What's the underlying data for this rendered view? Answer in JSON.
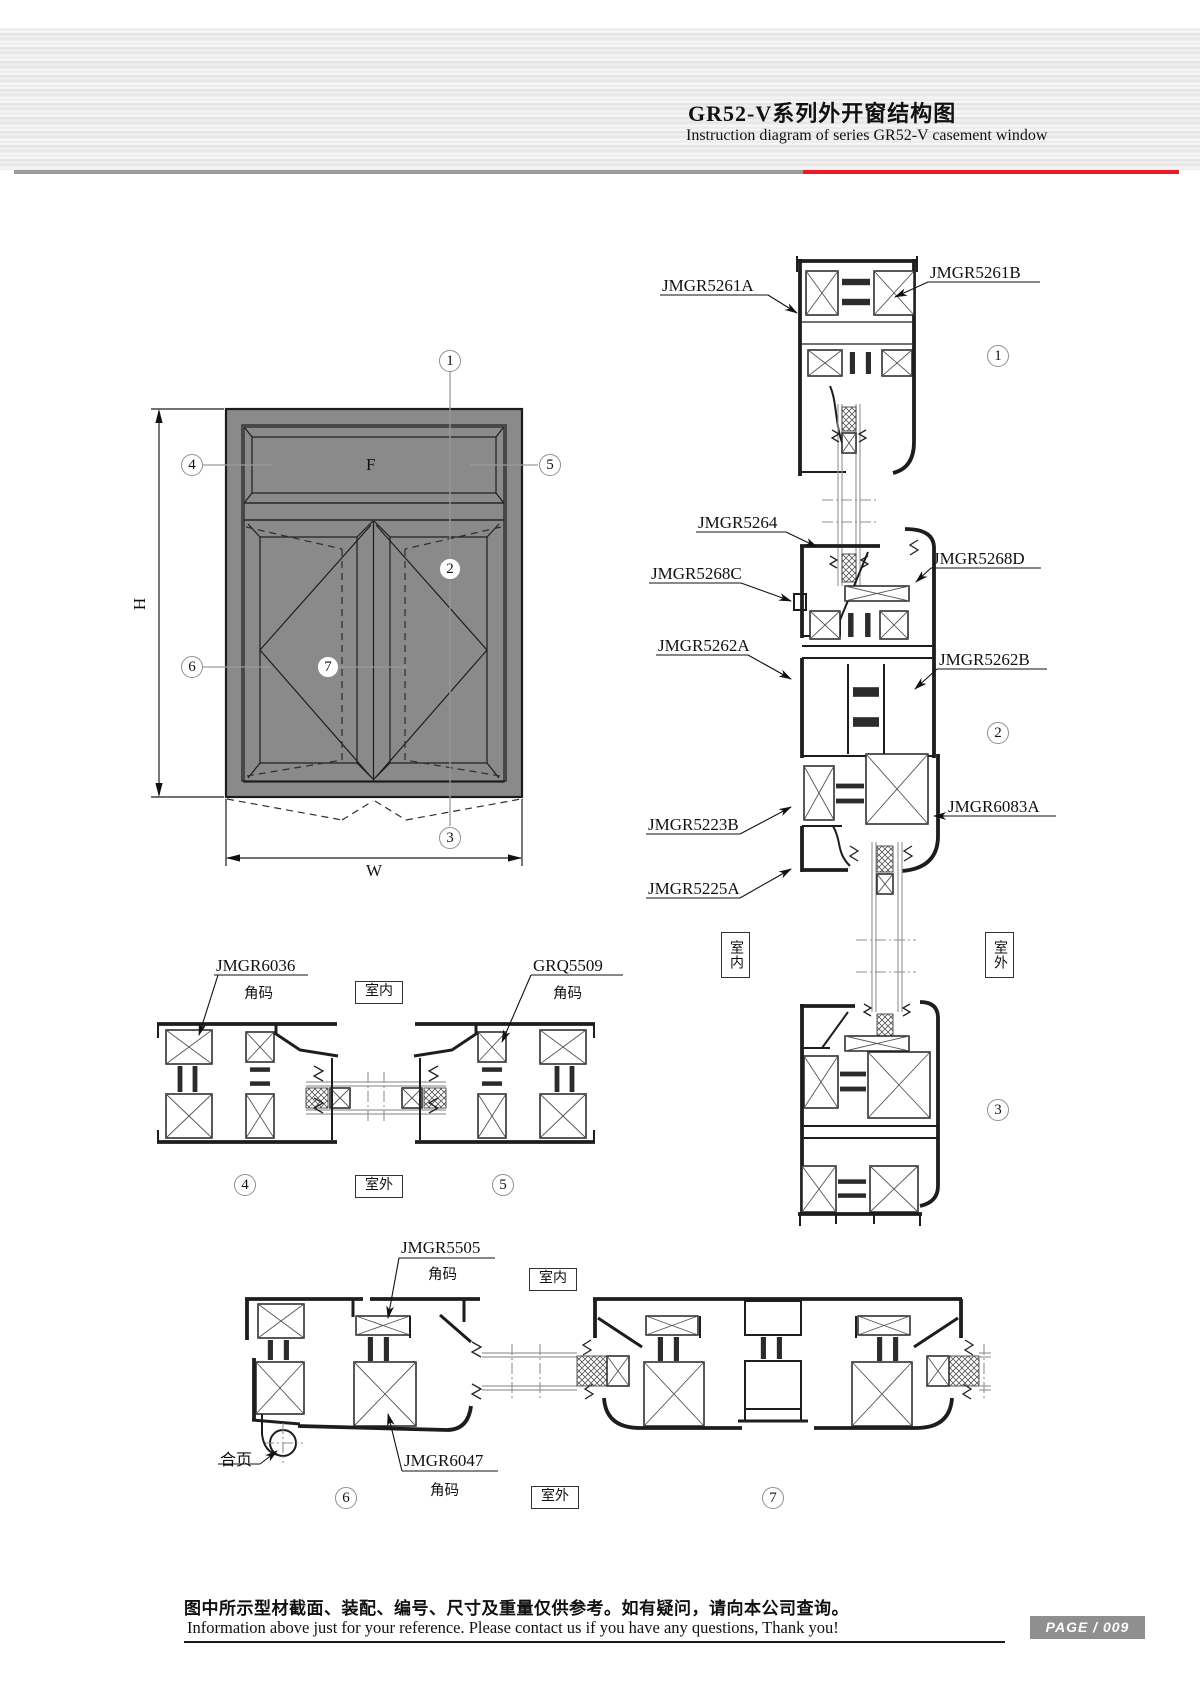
{
  "header": {
    "title": "GR52-V系列外开窗结构图",
    "subtitle": "Instruction diagram of series GR52-V casement window"
  },
  "elevation": {
    "height_label": "H",
    "width_label": "W",
    "fixed_panel_label": "F"
  },
  "callouts": {
    "c1": "1",
    "c2": "2",
    "c3": "3",
    "c4": "4",
    "c5": "5",
    "c6": "6",
    "c7": "7"
  },
  "parts": {
    "p5261a": "JMGR5261A",
    "p5261b": "JMGR5261B",
    "p5264": "JMGR5264",
    "p5268c": "JMGR5268C",
    "p5268d": "JMGR5268D",
    "p5262a": "JMGR5262A",
    "p5262b": "JMGR5262B",
    "p5223b": "JMGR5223B",
    "p6083a": "JMGR6083A",
    "p5225a": "JMGR5225A",
    "p6036": "JMGR6036",
    "pgrq5509": "GRQ5509",
    "p5505": "JMGR5505",
    "p6047": "JMGR6047"
  },
  "annotations": {
    "indoor": "室内",
    "outdoor": "室外",
    "corner_code": "角码",
    "hinge": "合页"
  },
  "footer": {
    "note_zh": "图中所示型材截面、装配、编号、尺寸及重量仅供参考。如有疑问，请向本公司查询。",
    "note_en": "Information above just for your reference. Please contact us if you have any questions, Thank you!",
    "page_label": "PAGE / 009"
  },
  "colors": {
    "accent_red": "#e81c24",
    "divider_gray": "#9c9c9c",
    "frame_gray": "#8a8a8a",
    "badge_gray": "#8f8f8f"
  }
}
